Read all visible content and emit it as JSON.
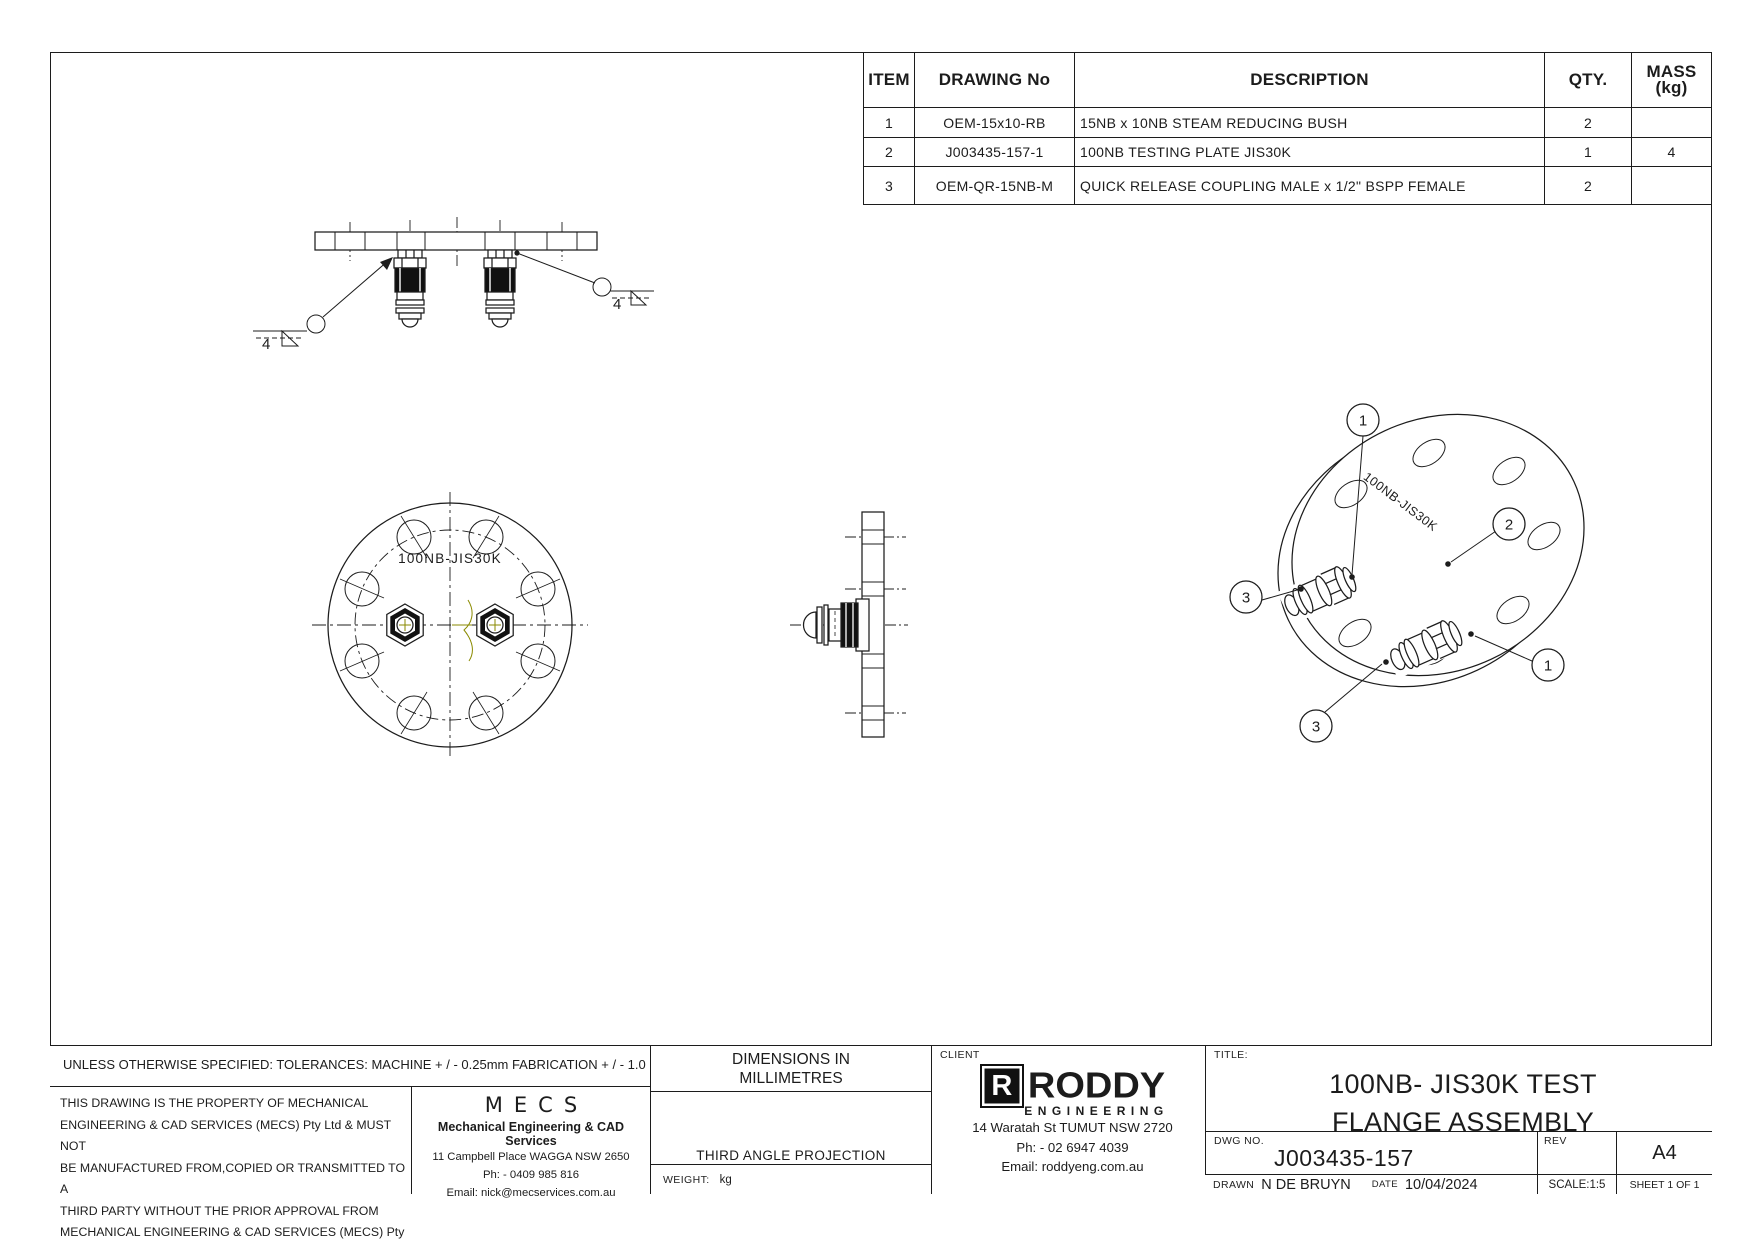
{
  "bom": {
    "headers": {
      "item": "ITEM",
      "drawing_no": "DRAWING No",
      "description": "DESCRIPTION",
      "qty": "QTY.",
      "mass": "MASS (kg)"
    },
    "rows": [
      {
        "item": "1",
        "drawing_no": "OEM-15x10-RB",
        "description": "15NB x 10NB STEAM REDUCING BUSH",
        "qty": "2",
        "mass": ""
      },
      {
        "item": "2",
        "drawing_no": "J003435-157-1",
        "description": "100NB TESTING PLATE JIS30K",
        "qty": "1",
        "mass": "4"
      },
      {
        "item": "3",
        "drawing_no": "OEM-QR-15NB-M",
        "description": "QUICK RELEASE COUPLING MALE x 1/2\" BSPP FEMALE",
        "qty": "2",
        "mass": ""
      }
    ]
  },
  "views": {
    "plate_label_front": "100NB-JIS30K",
    "plate_label_iso": "100NB-JIS30K",
    "weld_left_size": "4",
    "weld_right_size": "4",
    "balloons": [
      {
        "n": "1"
      },
      {
        "n": "2"
      },
      {
        "n": "3"
      },
      {
        "n": "1"
      },
      {
        "n": "3"
      }
    ]
  },
  "title_block": {
    "tolerance_note": "UNLESS OTHERWISE SPECIFIED: TOLERANCES: MACHINE + / - 0.25mm  FABRICATION + / - 1.0 mm",
    "property_lines": [
      "THIS DRAWING IS THE PROPERTY OF MECHANICAL",
      "ENGINEERING & CAD SERVICES (MECS) Pty Ltd & MUST NOT",
      "BE MANUFACTURED FROM,COPIED OR TRANSMITTED TO A",
      "THIRD PARTY WITHOUT THE PRIOR APPROVAL FROM",
      "MECHANICAL ENGINEERING & CAD SERVICES (MECS) Pty Ltd"
    ],
    "mecs": {
      "logo": "MECS",
      "name": "Mechanical Engineering & CAD Services",
      "address": "11 Campbell Place WAGGA NSW 2650",
      "phone": "Ph: - 0409 985 816",
      "email": "Email: nick@mecservices.com.au"
    },
    "dimensions_note": "DIMENSIONS IN MILLIMETRES",
    "projection_label": "THIRD ANGLE PROJECTION",
    "weight_label": "WEIGHT:",
    "weight_value": "kg",
    "client_label": "CLIENT",
    "client": {
      "logo_r": "R",
      "logo_name": "RODDY",
      "logo_sub": "ENGINEERING",
      "address": "14 Waratah St TUMUT NSW 2720",
      "phone": "Ph: - 02 6947 4039",
      "email": "Email: roddyeng.com.au"
    },
    "title_label": "TITLE:",
    "title_line1": "100NB- JIS30K TEST",
    "title_line2": "FLANGE ASSEMBLY",
    "dwg_label": "DWG NO.",
    "dwg_no": "J003435-157",
    "rev_label": "REV",
    "sheet_size": "A4",
    "drawn_label": "DRAWN",
    "drawn_by": "N DE BRUYN",
    "date_label": "DATE",
    "date": "10/04/2024",
    "scale": "SCALE:1:5",
    "sheet": "SHEET 1 OF 1"
  }
}
